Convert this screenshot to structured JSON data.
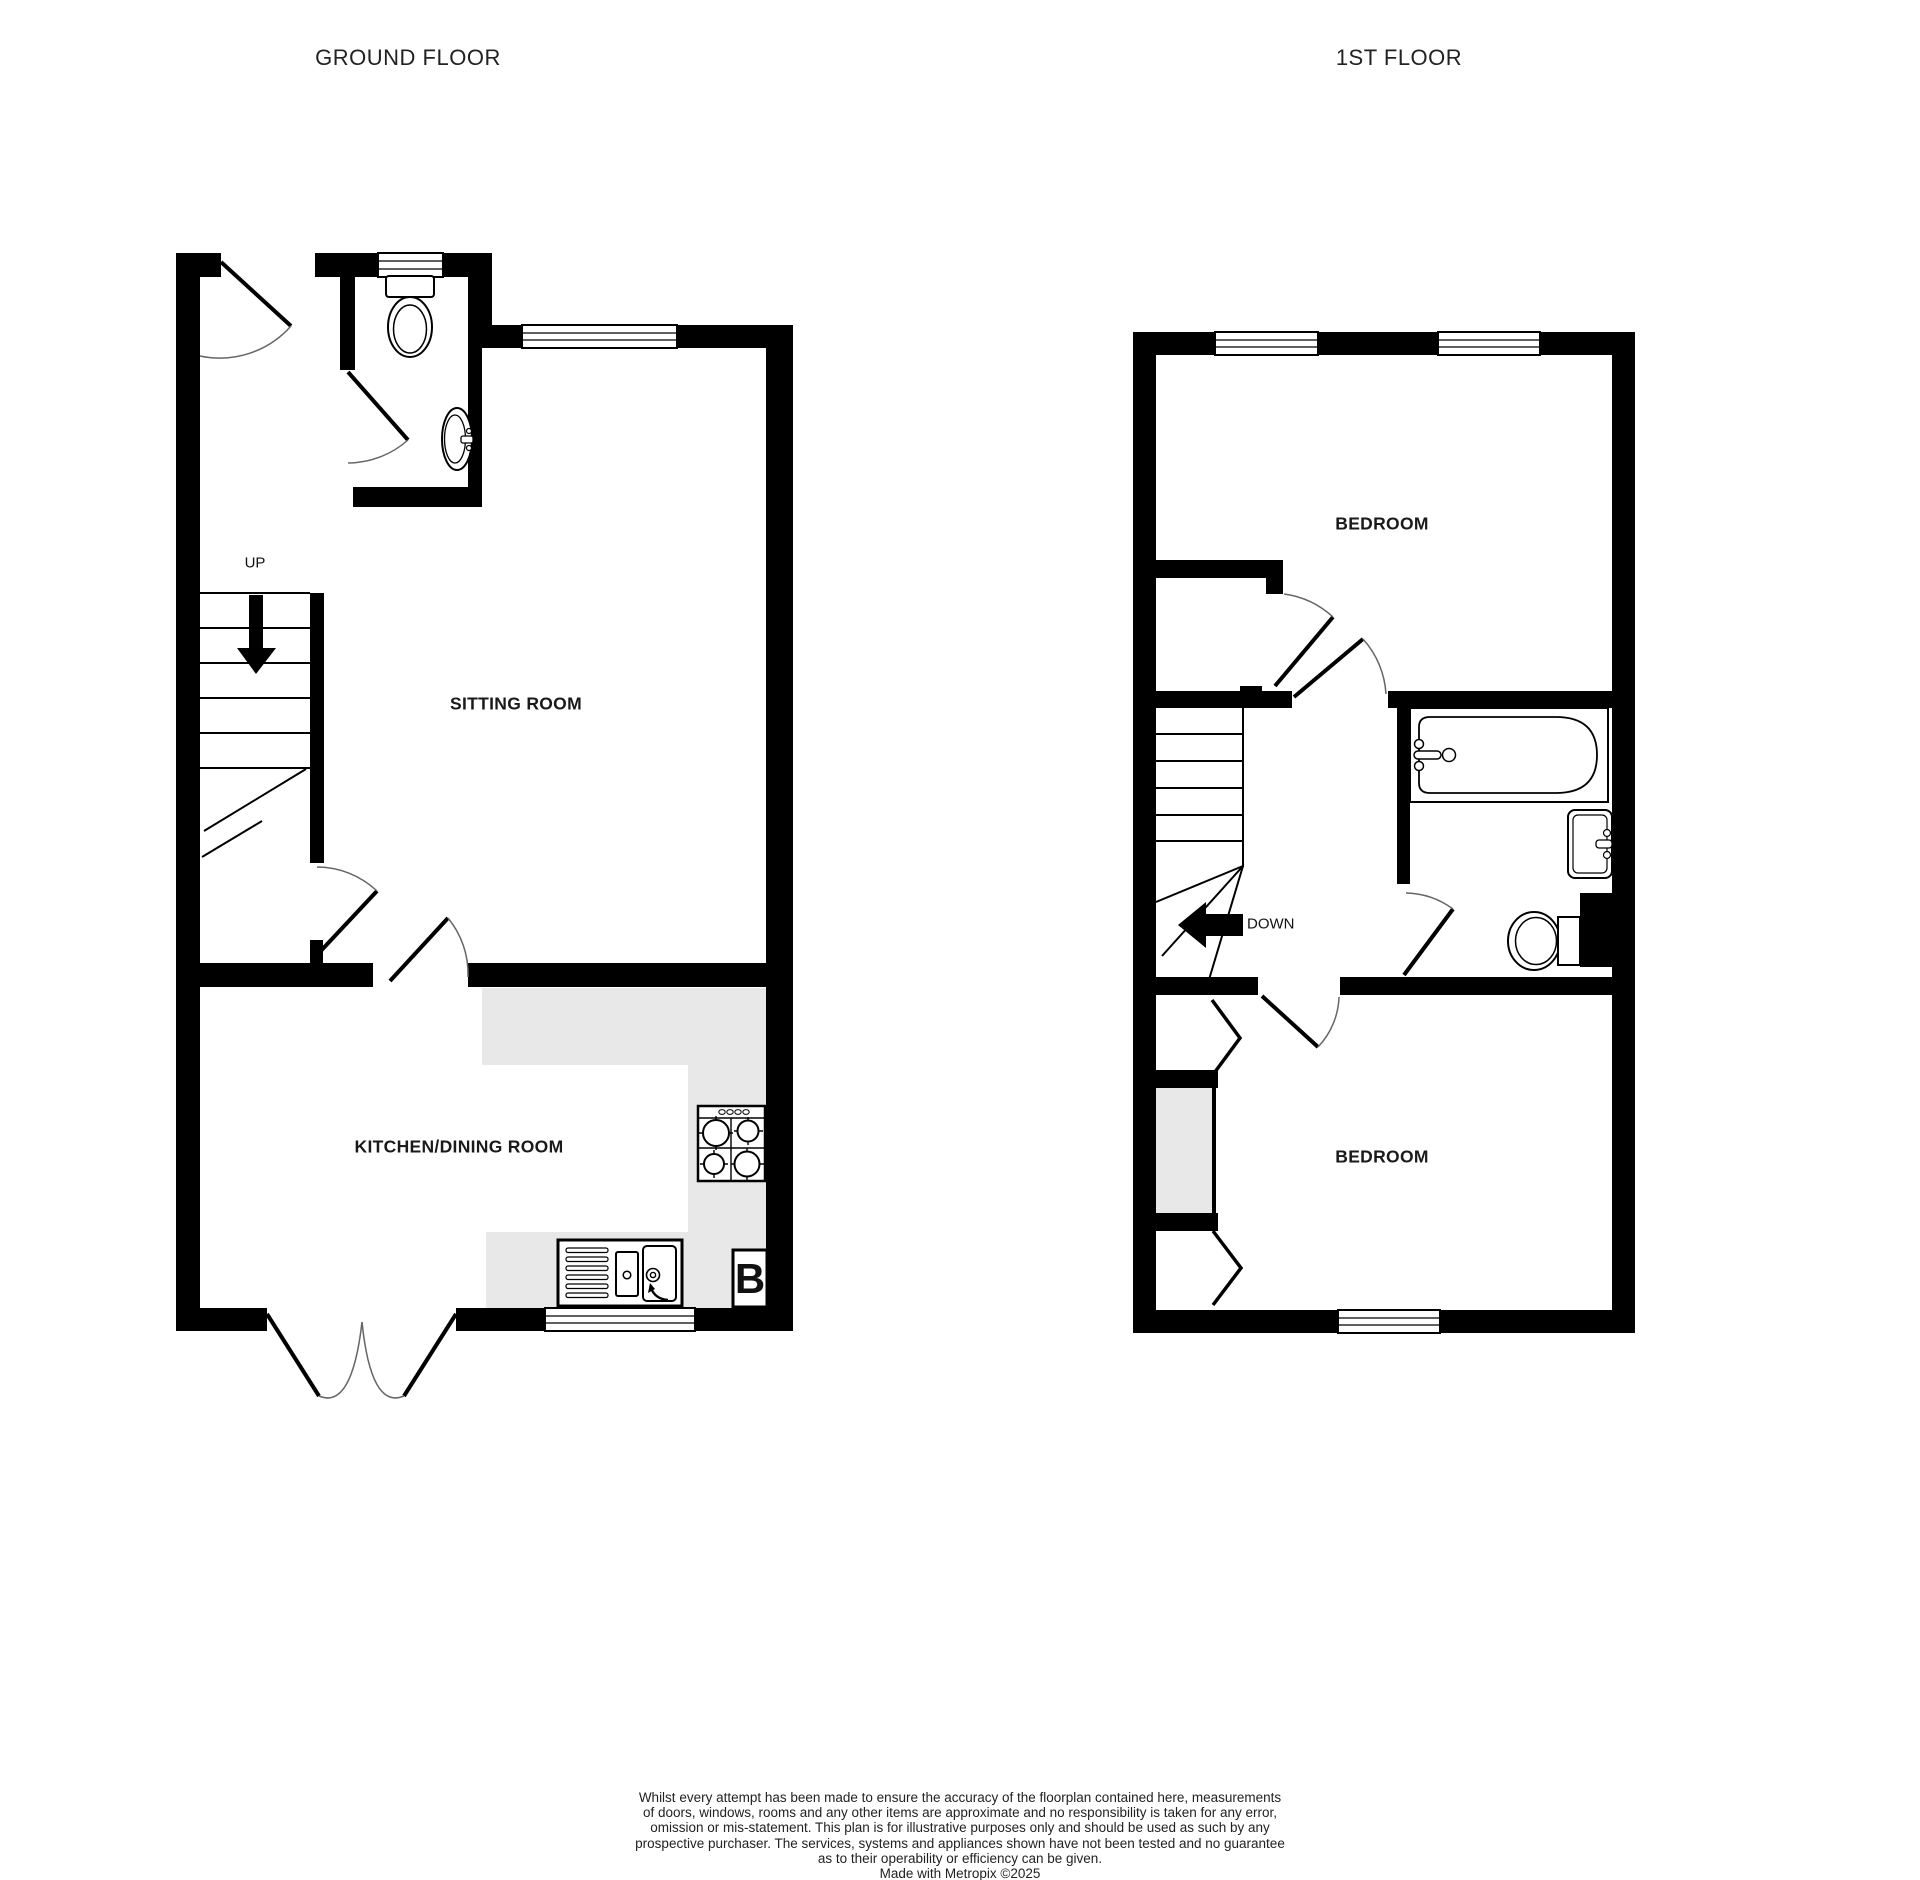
{
  "titles": {
    "ground": "GROUND FLOOR",
    "first": "1ST FLOOR"
  },
  "ground_floor": {
    "rooms": {
      "sitting": "SITTING ROOM",
      "kitchen": "KITCHEN/DINING ROOM"
    },
    "stairs": "UP",
    "boiler": "B"
  },
  "first_floor": {
    "rooms": {
      "bedroom1": "BEDROOM",
      "bedroom2": "BEDROOM"
    },
    "stairs": "DOWN"
  },
  "colors": {
    "wall": "#000000",
    "counter": "#e8e8e8",
    "arc": "#666666"
  },
  "disclaimer": {
    "lines": [
      "Whilst every attempt has been made to ensure the accuracy of the floorplan contained here, measurements",
      "of doors, windows, rooms and any other items are approximate and no responsibility is taken for any error,",
      "omission or mis-statement. This plan is for illustrative purposes only and should be used as such by any",
      "prospective purchaser. The services, systems and appliances shown have not been tested and no guarantee",
      "as to their operability or efficiency can be given.",
      "Made with Metropix ©2025"
    ]
  }
}
